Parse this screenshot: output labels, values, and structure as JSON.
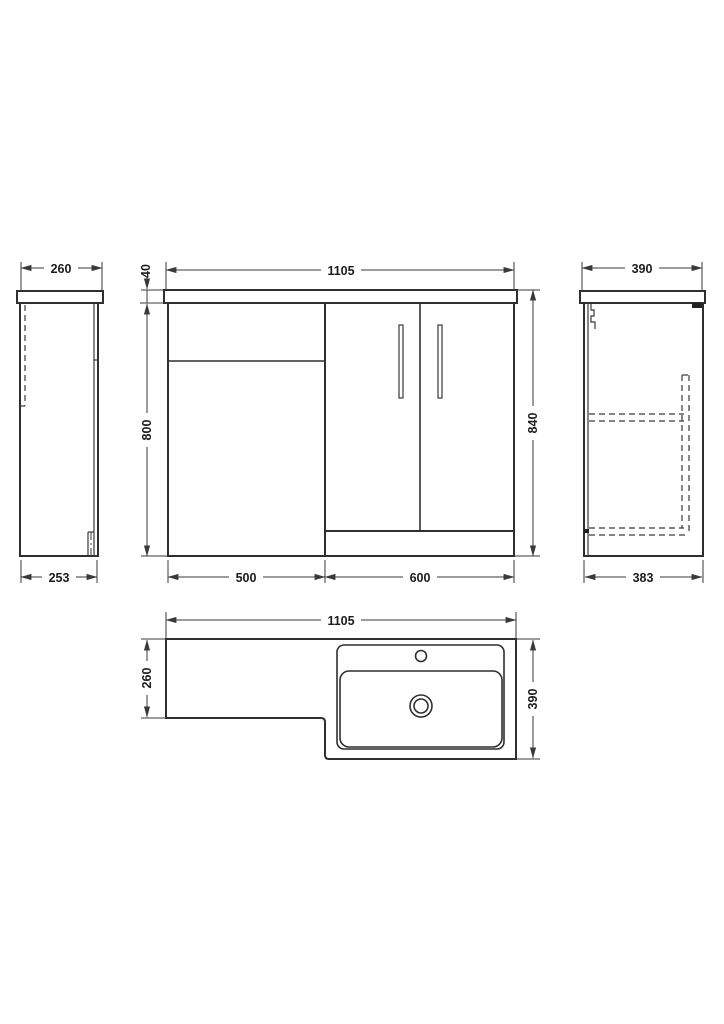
{
  "drawing": {
    "subject": "L-shaped bathroom vanity combination unit - dimensioned technical drawing",
    "units": "mm",
    "colors": {
      "line": "#3a3a3a",
      "text": "#1c1c1c",
      "background": "#ffffff"
    },
    "views": {
      "left_side": {
        "label": "left side elevation",
        "top_width": "260",
        "bottom_width": "253"
      },
      "front": {
        "label": "front elevation",
        "overall_width": "1105",
        "worktop_thickness": "40",
        "cabinet_height": "800",
        "overall_height": "840",
        "cabinet_section_width": "500",
        "basin_section_width": "600"
      },
      "right_side": {
        "label": "right side elevation",
        "top_depth": "390",
        "bottom_depth": "383"
      },
      "plan": {
        "label": "plan view",
        "overall_width": "1105",
        "cabinet_end_depth": "260",
        "basin_end_depth": "390"
      }
    }
  }
}
